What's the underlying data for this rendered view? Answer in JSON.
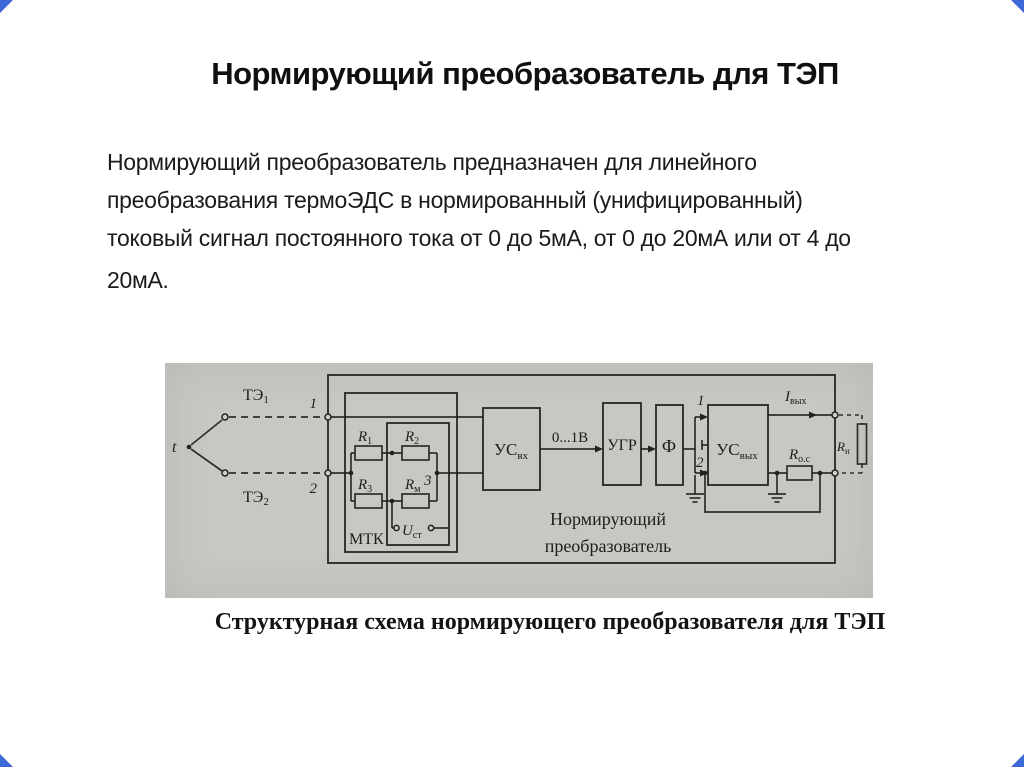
{
  "theme": {
    "accent": "#3e68d8",
    "panel": "#c7c7c3",
    "ink": "#22221d"
  },
  "content": {
    "title": "Нормирующий преобразователь для ТЭП",
    "paragraph": {
      "lines": [
        "Нормирующий преобразователь предназначен для линейного",
        "преобразования термоЭДС в нормированный (унифицированный)",
        "токовый сигнал постоянного тока от 0 до 5мА, от 0 до 20мА или от 4 до"
      ],
      "last_line": "20мА."
    },
    "caption": "Структурная схема нормирующего преобразователя для ТЭП"
  },
  "diagram": {
    "labels": {
      "t": "t",
      "te1": {
        "base": "ТЭ",
        "sub": "1"
      },
      "te2": {
        "base": "ТЭ",
        "sub": "2"
      },
      "term1": "1",
      "term2": "2",
      "mtk": "МТК",
      "r1": {
        "base": "R",
        "sub": "1"
      },
      "r2": {
        "base": "R",
        "sub": "2"
      },
      "r3": {
        "base": "R",
        "sub": "3"
      },
      "rm": {
        "base": "R",
        "sub": "м"
      },
      "node3": "3",
      "ust": {
        "base": "U",
        "sub": "ст"
      },
      "us_in": {
        "base": "УС",
        "sub": "вх"
      },
      "range": "0...1В",
      "ugr": "УГР",
      "filter": "Ф",
      "in1": "1",
      "in2": "2",
      "us_out": {
        "base": "УС",
        "sub": "вых"
      },
      "i_out": {
        "base": "I",
        "sub": "вых"
      },
      "r_oc": {
        "base": "R",
        "sub": "о.с"
      },
      "r_n": {
        "base": "R",
        "sub": "н"
      },
      "block_name_line1": "Нормирующий",
      "block_name_line2": "преобразователь"
    }
  }
}
